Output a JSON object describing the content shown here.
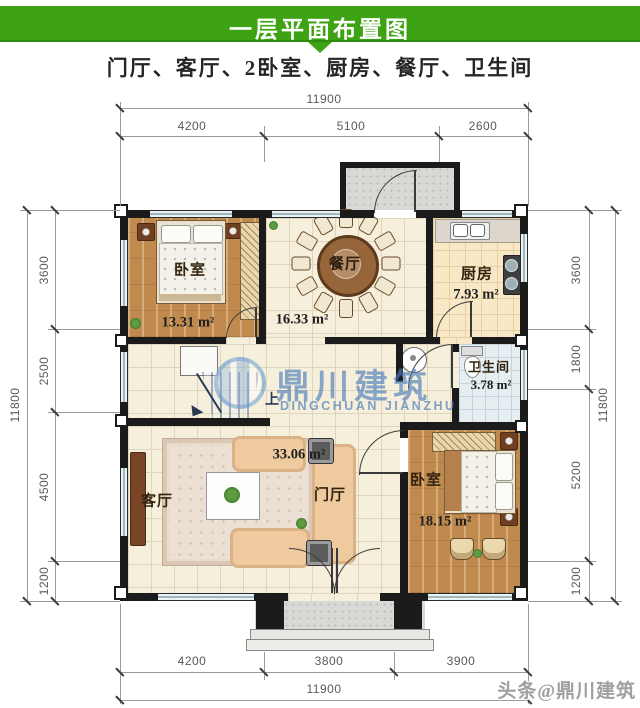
{
  "header": {
    "title": "一层平面布置图",
    "subtitle": "门厅、客厅、2卧室、厨房、餐厅、卫生间"
  },
  "dimensions": {
    "top": {
      "total": "11900",
      "segments": [
        "4200",
        "5100",
        "2600"
      ]
    },
    "bottom": {
      "total": "11900",
      "segments": [
        "4200",
        "3800",
        "3900"
      ]
    },
    "left": {
      "total": "11800",
      "segments": [
        "3600",
        "2500",
        "4500",
        "1200"
      ]
    },
    "right": {
      "total": "11800",
      "segments": [
        "3600",
        "1800",
        "5200",
        "1200"
      ]
    }
  },
  "rooms": {
    "bedroom1": {
      "name": "卧室",
      "area": "13.31 m²"
    },
    "dining": {
      "name": "餐厅",
      "area": "16.33 m²"
    },
    "kitchen": {
      "name": "厨房",
      "area": "7.93 m²"
    },
    "bathroom": {
      "name": "卫生间",
      "area": "3.78 m²"
    },
    "living": {
      "name": "客厅"
    },
    "hall": {
      "name": "门厅",
      "area": "33.06 m²"
    },
    "bedroom2": {
      "name": "卧室",
      "area": "18.15 m²"
    }
  },
  "stair": {
    "direction_label": "上"
  },
  "watermark": {
    "brand_cn": "鼎川建筑",
    "brand_en": "DINGCHUAN JIANZHU",
    "corner": "头条@鼎川建筑"
  },
  "colors": {
    "header_green": "#3ea313",
    "wall_black": "#1b1b1b",
    "watermark_blue": "#4d86c4"
  }
}
